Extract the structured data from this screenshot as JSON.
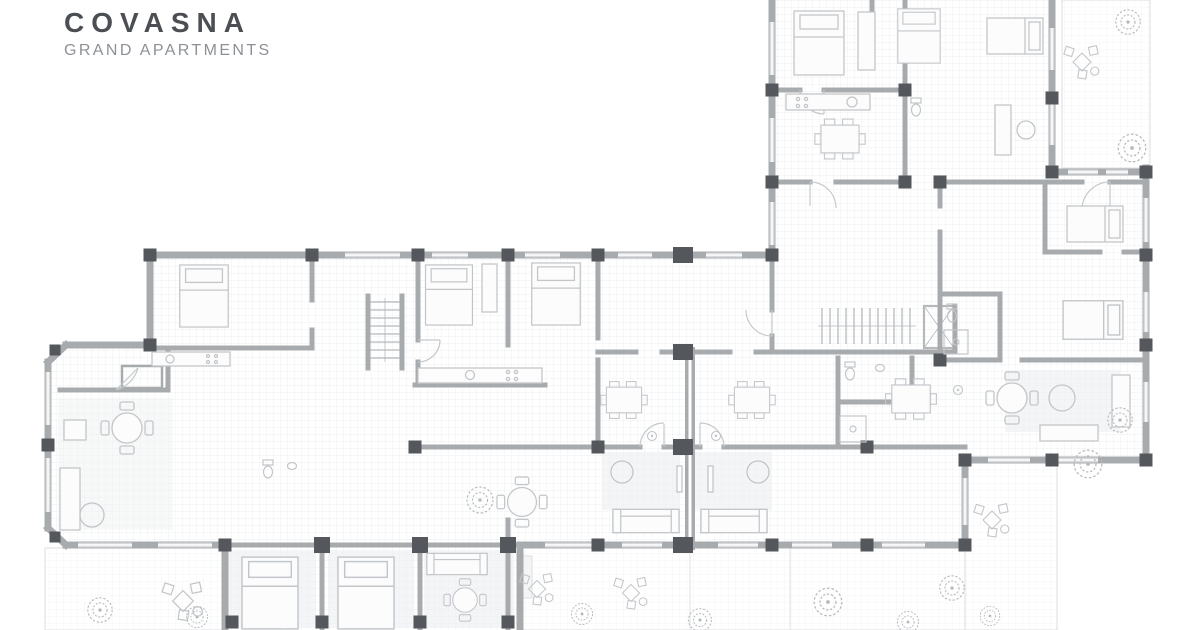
{
  "brand": {
    "name": "COVASNA",
    "tagline": "GRAND APARTMENTS"
  },
  "palette": {
    "background": "#ffffff",
    "wall": "#a8abae",
    "column": "#54575b",
    "window_band": "#d8dadc",
    "furniture": "#c3c6c9",
    "door": "#c6c9cb",
    "tree": "#b8bbbe",
    "floor_grid": "#e8eaed",
    "terrace_grid": "#f0f1f3",
    "brand_name_color": "#4b4f54",
    "brand_tagline_color": "#8d9196"
  }
}
